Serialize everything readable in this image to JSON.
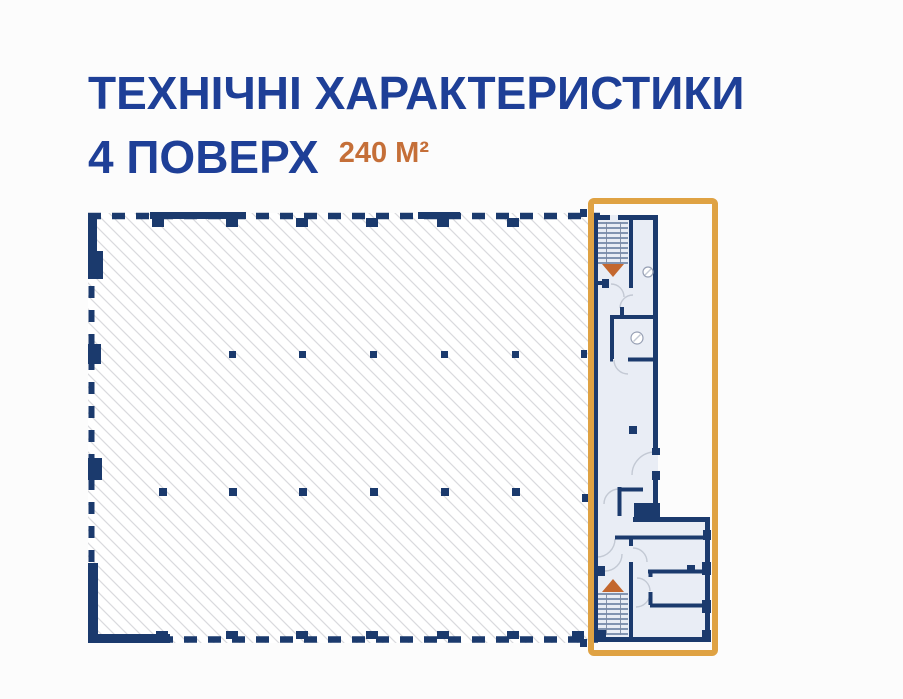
{
  "header": {
    "title": "ТЕХНІЧНІ ХАРАКТЕРИСТИКИ",
    "floor_label": "4 ПОВЕРХ",
    "area_label": "240 М²"
  },
  "floor_plan": {
    "floor_number": 4,
    "highlighted_area_sqm": 240,
    "description": "floor-plan-with-highlighted-right-section",
    "icons": [
      "stairs-down-arrow-icon",
      "stairs-up-arrow-icon",
      "drain-symbol-icon",
      "column-marker"
    ]
  },
  "colors": {
    "title_blue": "#1e3f97",
    "area_orange": "#c56f38",
    "wall_navy": "#1b3a6d",
    "room_fill": "#e9edf5",
    "hatch_gray": "#d9dadd",
    "frame_orange": "#dfa243",
    "arrow_orange": "#c3672e"
  }
}
